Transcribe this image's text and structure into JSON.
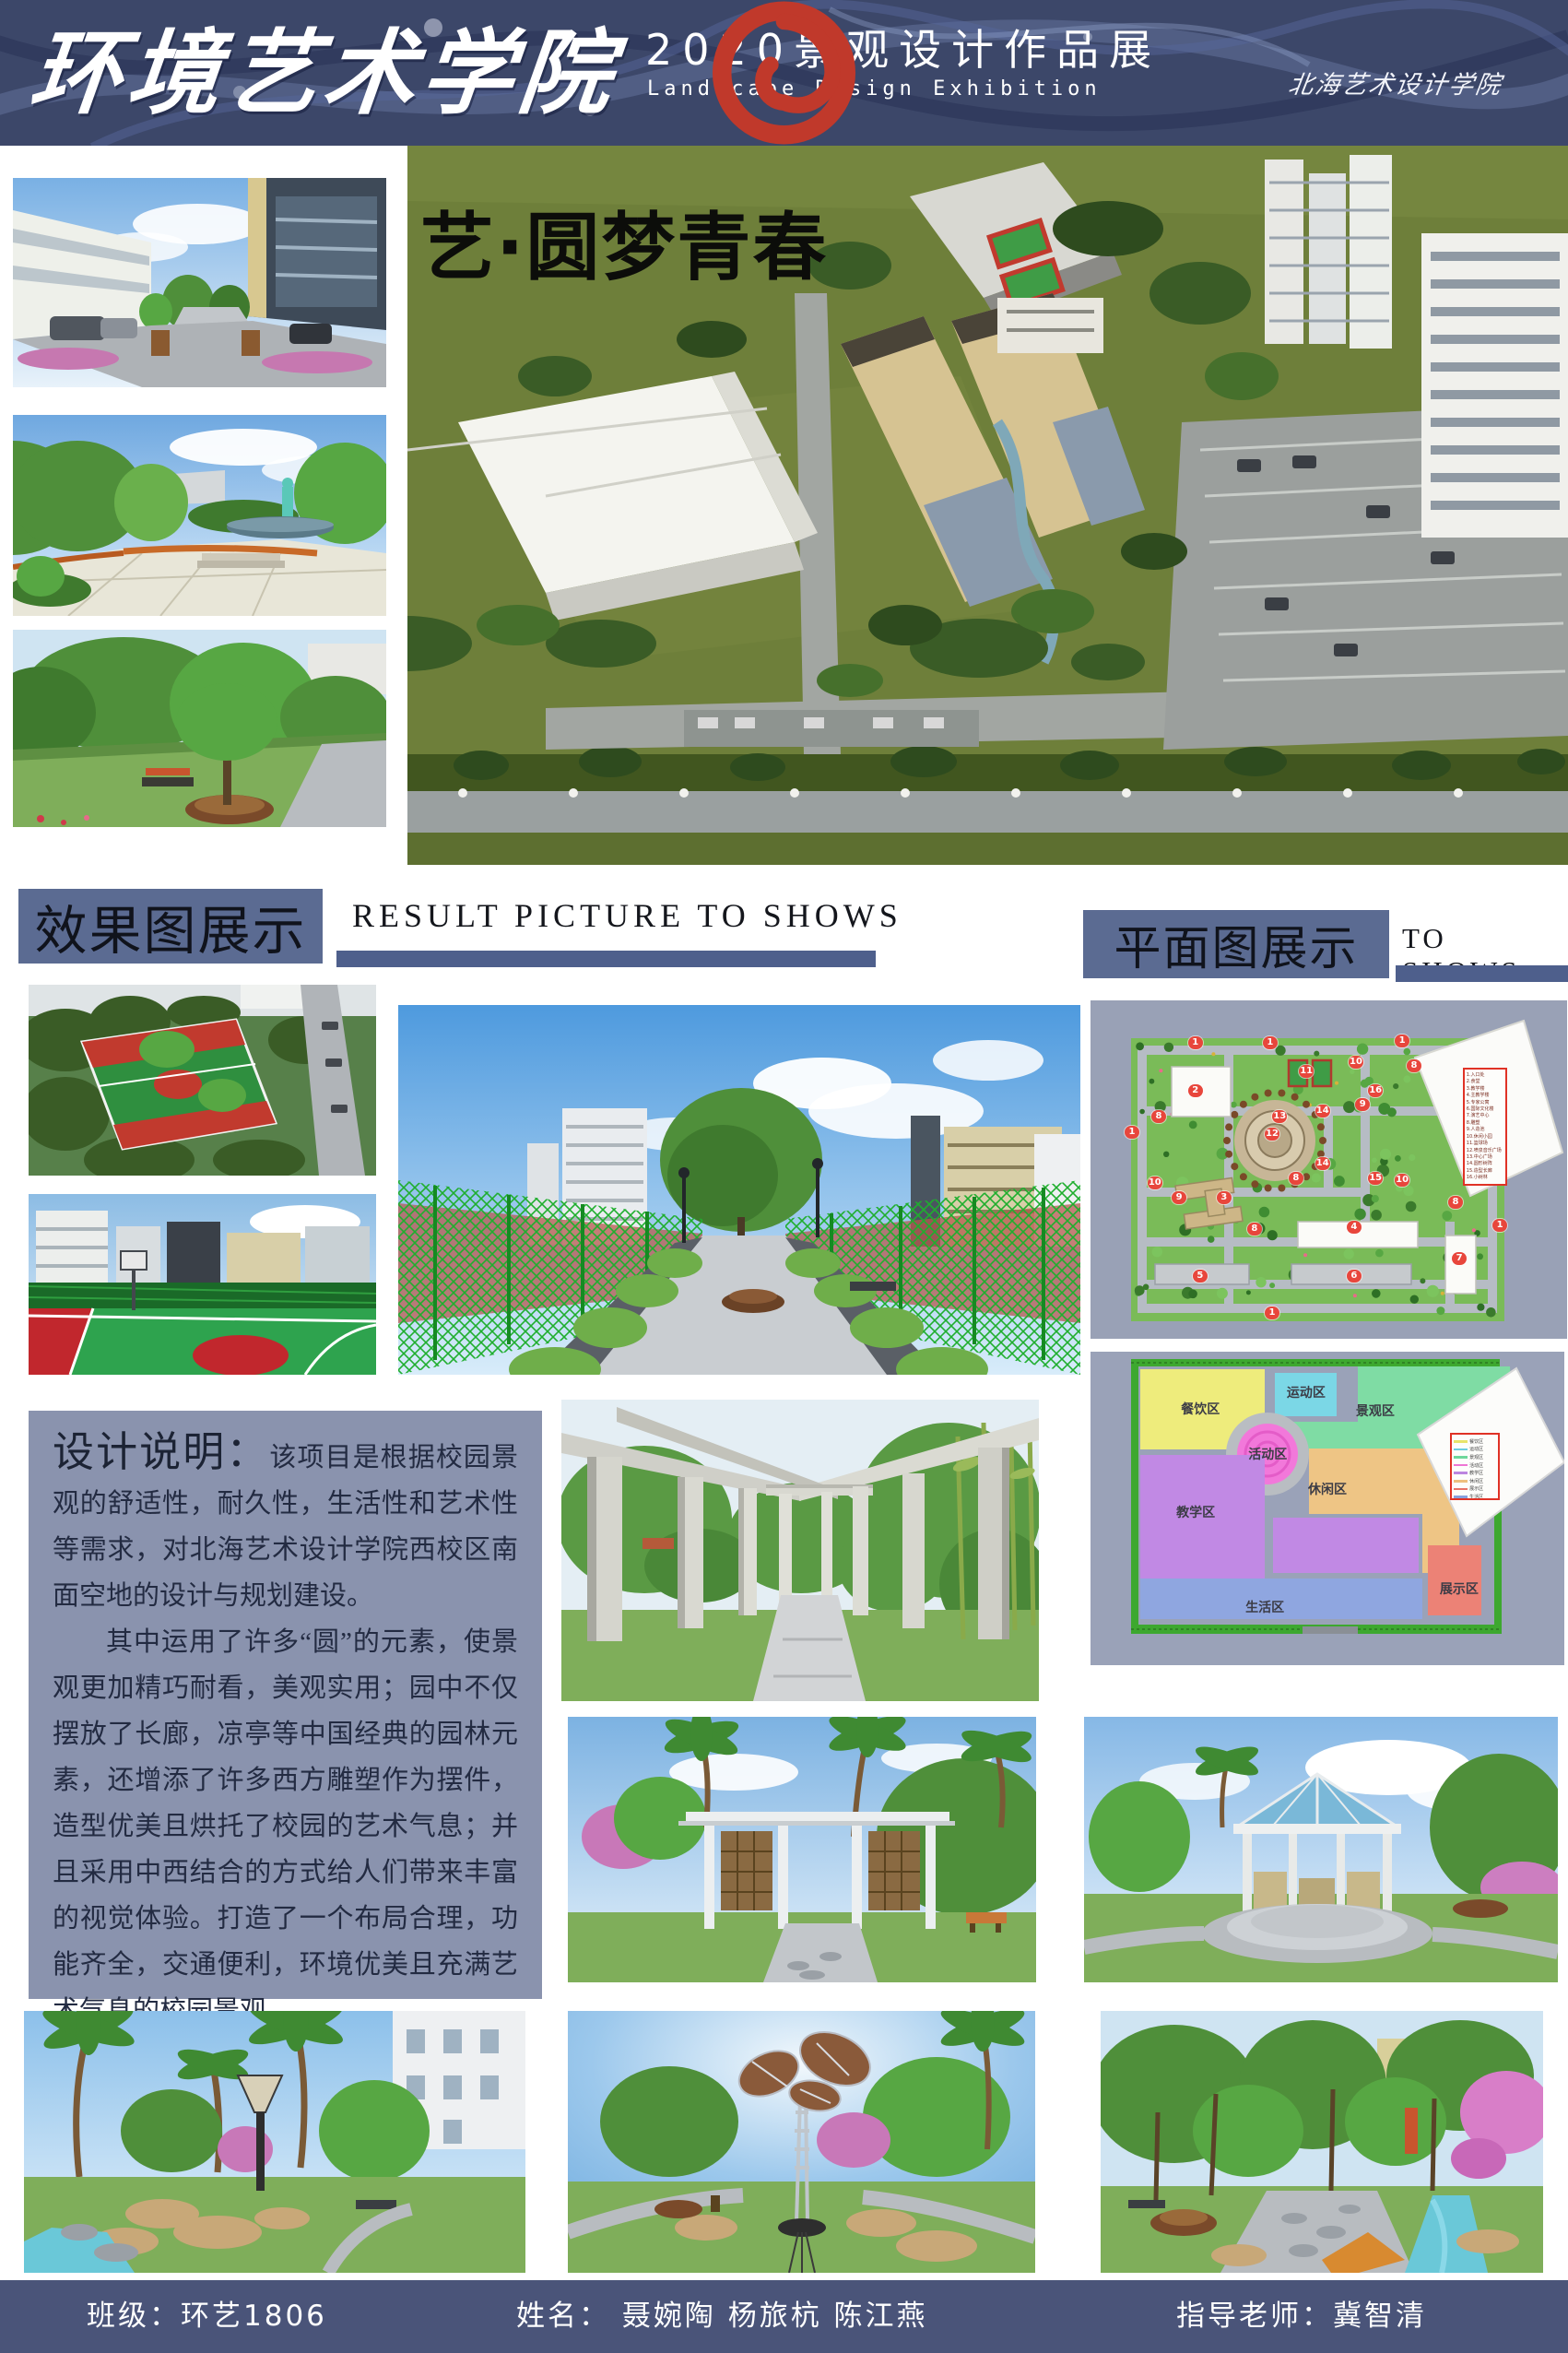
{
  "header": {
    "college_title": "环境艺术学院",
    "exhibition_title": "2020景观设计作品展",
    "exhibition_subtitle": "Landscape Design Exhibition",
    "school_name": "北海艺术设计学院"
  },
  "main_render": {
    "title": "艺·圆梦青春"
  },
  "sections": {
    "effect": {
      "title": "效果图展示",
      "subtitle": "RESULT PICTURE TO SHOWS"
    },
    "plan": {
      "title": "平面图展示",
      "subtitle": "TO SHOWS"
    }
  },
  "description": {
    "title": "设计说明：",
    "lead": "该项目是根据校园景观的舒适性，耐久性，生活性和艺术性等需求，对北海艺术设计学院西校区南面空地的设计与规划建设。",
    "paragraph2": "其中运用了许多“圆”的元素，使景观更加精巧耐看，美观实用；园中不仅摆放了长廊，凉亭等中国经典的园林元素，还增添了许多西方雕塑作为摆件，造型优美且烘托了校园的艺术气息；并且采用中西结合的方式给人们带来丰富的视觉体验。打造了一个布局合理，功能齐全，交通便利，环境优美且充满艺术气息的校园景观。"
  },
  "site_plan": {
    "markers": [
      {
        "n": "1",
        "x": 22.0,
        "y": 12.5
      },
      {
        "n": "1",
        "x": 37.7,
        "y": 12.5
      },
      {
        "n": "1",
        "x": 65.4,
        "y": 12.0
      },
      {
        "n": "1",
        "x": 8.7,
        "y": 39.0
      },
      {
        "n": "1",
        "x": 85.9,
        "y": 66.5
      },
      {
        "n": "1",
        "x": 38.1,
        "y": 92.4
      },
      {
        "n": "2",
        "x": 22.0,
        "y": 26.7
      },
      {
        "n": "3",
        "x": 28.0,
        "y": 58.3
      },
      {
        "n": "4",
        "x": 55.3,
        "y": 67.0
      },
      {
        "n": "5",
        "x": 23.0,
        "y": 81.5
      },
      {
        "n": "6",
        "x": 55.3,
        "y": 81.5
      },
      {
        "n": "7",
        "x": 77.4,
        "y": 76.3
      },
      {
        "n": "8",
        "x": 14.3,
        "y": 34.3
      },
      {
        "n": "8",
        "x": 43.1,
        "y": 52.6
      },
      {
        "n": "8",
        "x": 67.9,
        "y": 19.3
      },
      {
        "n": "8",
        "x": 76.6,
        "y": 59.7
      },
      {
        "n": "8",
        "x": 34.4,
        "y": 67.6
      },
      {
        "n": "9",
        "x": 18.6,
        "y": 58.3
      },
      {
        "n": "9",
        "x": 57.1,
        "y": 30.8
      },
      {
        "n": "10",
        "x": 13.5,
        "y": 54.0
      },
      {
        "n": "10",
        "x": 55.7,
        "y": 18.3
      },
      {
        "n": "10",
        "x": 65.4,
        "y": 53.1
      },
      {
        "n": "11",
        "x": 45.3,
        "y": 21.0
      },
      {
        "n": "12",
        "x": 38.1,
        "y": 39.5
      },
      {
        "n": "13",
        "x": 39.7,
        "y": 34.3
      },
      {
        "n": "14",
        "x": 48.7,
        "y": 32.7
      },
      {
        "n": "14",
        "x": 48.7,
        "y": 48.2
      },
      {
        "n": "15",
        "x": 59.8,
        "y": 52.6
      },
      {
        "n": "16",
        "x": 59.8,
        "y": 26.7
      }
    ],
    "legend": [
      "1.入口处",
      "2.食堂",
      "3.教学楼",
      "4.主教学楼",
      "5.专家公寓",
      "6.国际文化楼",
      "7.演艺中心",
      "8.雕塑",
      "9.人造池",
      "10.休闲小园",
      "11.篮球场",
      "12.喷泉音乐广场",
      "13.中心广场",
      "14.圆形树阵",
      "15.造型长廊",
      "16.小树林"
    ]
  },
  "zone_plan": {
    "zones": [
      {
        "label": "餐饮区",
        "x": 23.2,
        "y": 18.2
      },
      {
        "label": "运动区",
        "x": 45.5,
        "y": 12.9
      },
      {
        "label": "景观区",
        "x": 60.1,
        "y": 18.8
      },
      {
        "label": "活动区",
        "x": 37.4,
        "y": 32.6
      },
      {
        "label": "休闲区",
        "x": 50.0,
        "y": 43.8
      },
      {
        "label": "教学区",
        "x": 22.2,
        "y": 51.2
      },
      {
        "label": "生活区",
        "x": 36.8,
        "y": 81.5
      },
      {
        "label": "展示区",
        "x": 77.8,
        "y": 75.6
      }
    ],
    "legend": [
      {
        "label": "餐饮区",
        "color": "#e8e46a"
      },
      {
        "label": "运动区",
        "color": "#6ccde0"
      },
      {
        "label": "景观区",
        "color": "#6fd79c"
      },
      {
        "label": "活动区",
        "color": "#ee75d4"
      },
      {
        "label": "教学区",
        "color": "#bc85e0"
      },
      {
        "label": "休闲区",
        "color": "#eec07f"
      },
      {
        "label": "展示区",
        "color": "#e87468"
      },
      {
        "label": "生活区",
        "color": "#87a0dd"
      }
    ]
  },
  "footer": {
    "class_label": "班级：环艺1806",
    "names_label": "姓名：  聂婉陶  杨旅杭  陈江燕",
    "advisor_label": "指导老师：冀智清"
  },
  "colors": {
    "header_navy": "#3c4769",
    "footer_navy": "#4a5479",
    "section_slate": "#5b6b92",
    "bar_blue": "#4e5f8c",
    "desc_slate": "#8a93ae",
    "marker_red": "#e8463c",
    "logo_red": "#c0392b"
  }
}
